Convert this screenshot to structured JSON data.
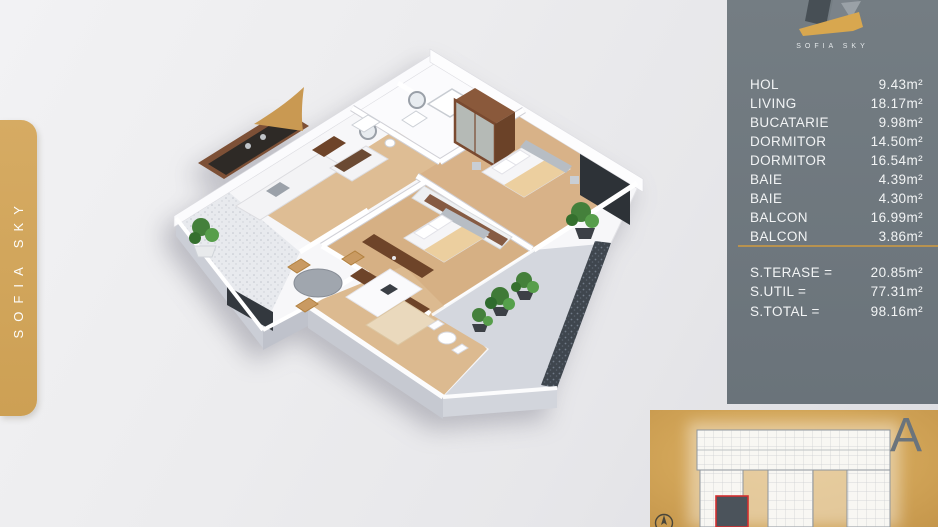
{
  "brand": {
    "logo_text": "SOFIA SKY",
    "sidebar_text": "SOFIA SKY"
  },
  "summary_panel": {
    "rooms": [
      {
        "label": "HOL",
        "area": "9.43m²"
      },
      {
        "label": "LIVING",
        "area": "18.17m²"
      },
      {
        "label": "BUCATARIE",
        "area": "9.98m²"
      },
      {
        "label": "DORMITOR",
        "area": "14.50m²"
      },
      {
        "label": "DORMITOR",
        "area": "16.54m²"
      },
      {
        "label": "BAIE",
        "area": "4.39m²"
      },
      {
        "label": "BAIE",
        "area": "4.30m²"
      },
      {
        "label": "BALCON",
        "area": "16.99m²"
      },
      {
        "label": "BALCON",
        "area": "3.86m²"
      }
    ],
    "totals": [
      {
        "label": "S.TERASE =",
        "value": "20.85m²"
      },
      {
        "label": "S.UTIL =",
        "value": "77.31m²"
      },
      {
        "label": "S.TOTAL =",
        "value": "98.16m²"
      }
    ]
  },
  "site_plan": {
    "section_letter": "A"
  },
  "colors": {
    "gold": "#d0a45c",
    "gold_divider": "#b8924f",
    "panel_gray": "#6e777d",
    "background": "#e9e9eb",
    "highlight_red": "#d32f2f",
    "wood_floor": "#d9b78c",
    "dark_wall": "#2e3338"
  }
}
